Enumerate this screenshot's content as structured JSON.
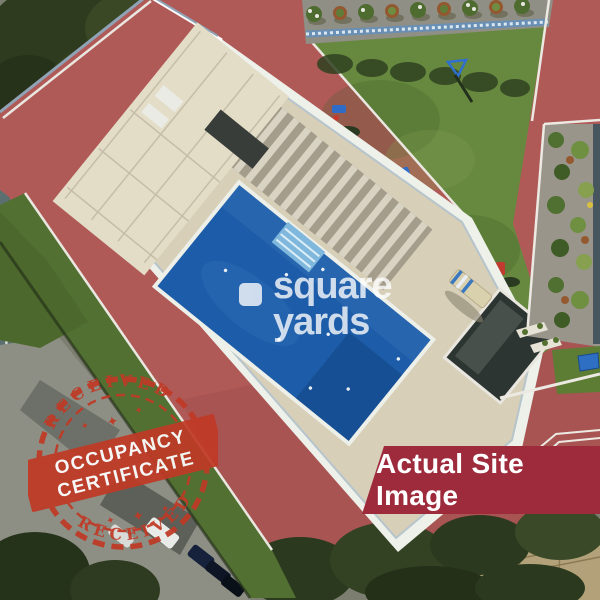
{
  "watermark": {
    "icon": "square-tile-icon",
    "line1": "square",
    "line2": "yards",
    "color": "#ffffff"
  },
  "stamp": {
    "arc_top": "RECEIVED",
    "arc_bottom": "RECEIVED",
    "band_line1": "OCCUPANCY",
    "band_line2": "CERTIFICATE",
    "color": "#c03a26"
  },
  "banner": {
    "label": "Actual Site Image",
    "bg_color": "#9e2b3c",
    "text_color": "#ffffff"
  },
  "photo": {
    "type": "aerial site photograph",
    "features": [
      "swimming-pool",
      "pool-deck",
      "pergola-slats",
      "rooftop-lawn",
      "outdoor-gym-equipment",
      "red-jogging-track",
      "planter-beds",
      "potted-plants-row",
      "street-level-parking",
      "parked-cars",
      "trees",
      "adjacent-buildings",
      "lounge-chair",
      "dark-glass-cabana"
    ],
    "palette": {
      "track_red": "#b05a58",
      "lawn_green": "#66893f",
      "pool_blue": "#1d5ca8",
      "deck_beige": "#d7cfb8",
      "railing_white": "#eef0ea",
      "street_gray": "#8d8e84",
      "tree_green": "#2b3a1e"
    }
  }
}
